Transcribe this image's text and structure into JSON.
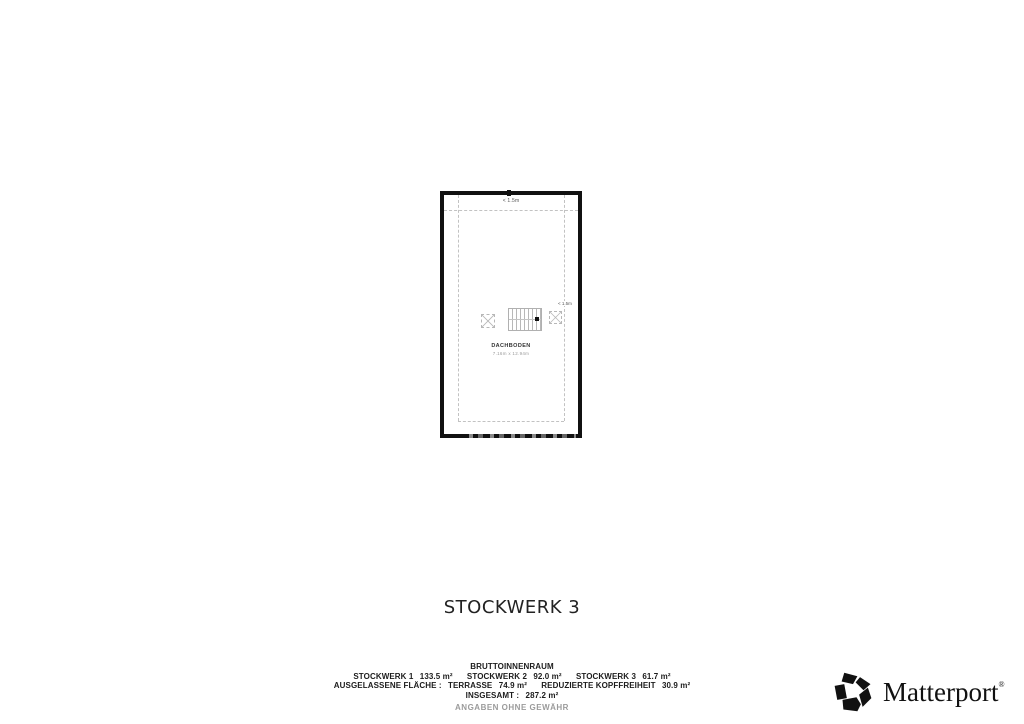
{
  "floorplan": {
    "title": "STOCKWERK 3",
    "room": {
      "name": "DACHBODEN",
      "dimensions": "7.16m x 12.94m"
    },
    "clearance_labels": {
      "top": "< 1.5m",
      "right": "< 1.5m"
    }
  },
  "summary": {
    "heading": "BRUTTOINNENRAUM",
    "floors": [
      {
        "label": "STOCKWERK 1",
        "area": "133.5 m²"
      },
      {
        "label": "STOCKWERK 2",
        "area": "92.0 m²"
      },
      {
        "label": "STOCKWERK 3",
        "area": "61.7 m²"
      }
    ],
    "excluded": {
      "label": "AUSGELASSENE FLÄCHE :",
      "items": [
        {
          "label": "TERRASSE",
          "area": "74.9 m²"
        },
        {
          "label": "REDUZIERTE KOPFFREIHEIT",
          "area": "30.9 m²"
        }
      ]
    },
    "total": {
      "label": "INSGESAMT :",
      "area": "287.2 m²"
    },
    "disclaimer": "ANGABEN OHNE GEWÄHR"
  },
  "branding": {
    "name": "Matterport",
    "registered_mark": "®",
    "icon": "matterport-pinwheel-icon"
  },
  "colors": {
    "wall": "#111111",
    "dashed_line": "#c2c2c2",
    "text_dark": "#1c1c1c",
    "text_muted": "#9b9b9b",
    "logo": "#111111"
  }
}
